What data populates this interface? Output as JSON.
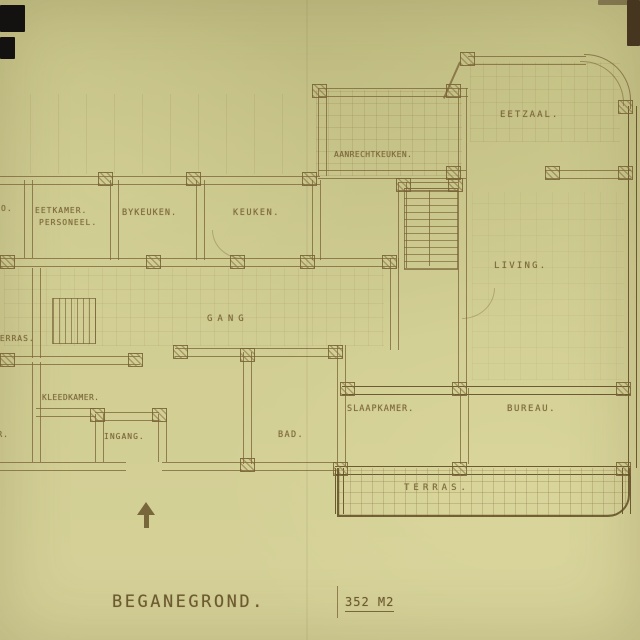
{
  "drawing": {
    "title": "BEGANEGROND.",
    "area": "352 M2",
    "rooms": {
      "eetzaal": "EETZAAL.",
      "aanrechtkeuken": "AANRECHTKEUKEN.",
      "eetkamer": "EETKAMER.",
      "eetkamer_sub": "PERSONEEL.",
      "bykeuken": "BYKEUKEN.",
      "keuken": "KEUKEN.",
      "living": "LIVING.",
      "gang": "GANG",
      "terras_west": "TERRAS.",
      "kleedkamer": "KLEEDKAMER.",
      "slaapkamer_sw": "SLAAPKAMER.",
      "ingang": "INGANG.",
      "bad": "BAD.",
      "slaapkamer": "SLAAPKAMER.",
      "bureau": "BUREAU.",
      "terras": "TERRAS.",
      "clipped_room": "O."
    },
    "colors": {
      "paper": "#cfcb90",
      "ink": "#7d673a",
      "ink_dark": "#5f4c28"
    }
  }
}
